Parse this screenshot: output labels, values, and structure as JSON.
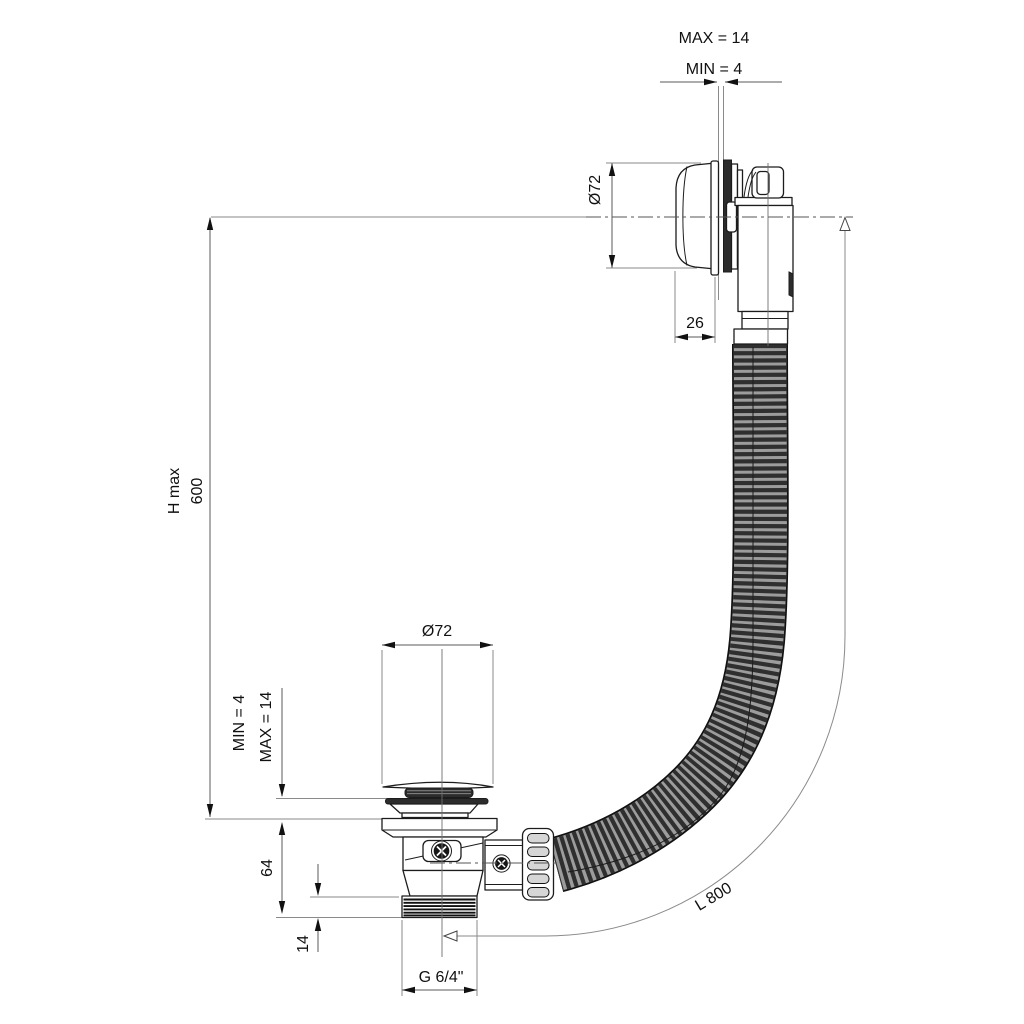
{
  "drawing": {
    "description": "Bath waste and overflow filler with flexible hose - dimensioned technical drawing",
    "dimensions": {
      "panel_thickness_max": "MAX = 14",
      "panel_thickness_min": "MIN = 4",
      "overflow_diameter": "Ø72",
      "overflow_cap_depth": "26",
      "height_label": "H max",
      "height_value": "600",
      "floor_thickness_min": "MIN = 4",
      "floor_thickness_max": "MAX = 14",
      "waste_diameter": "Ø72",
      "waste_body_height": "64",
      "thread_length": "14",
      "thread_spec": "G 6/4\"",
      "hose_length": "L 800"
    },
    "colors": {
      "line": "#1c1c1c",
      "dimension_line": "#5a5a5a",
      "hose_base": "#9c9c9c",
      "hose_rib": "#2f2f2f",
      "background": "#ffffff"
    }
  }
}
